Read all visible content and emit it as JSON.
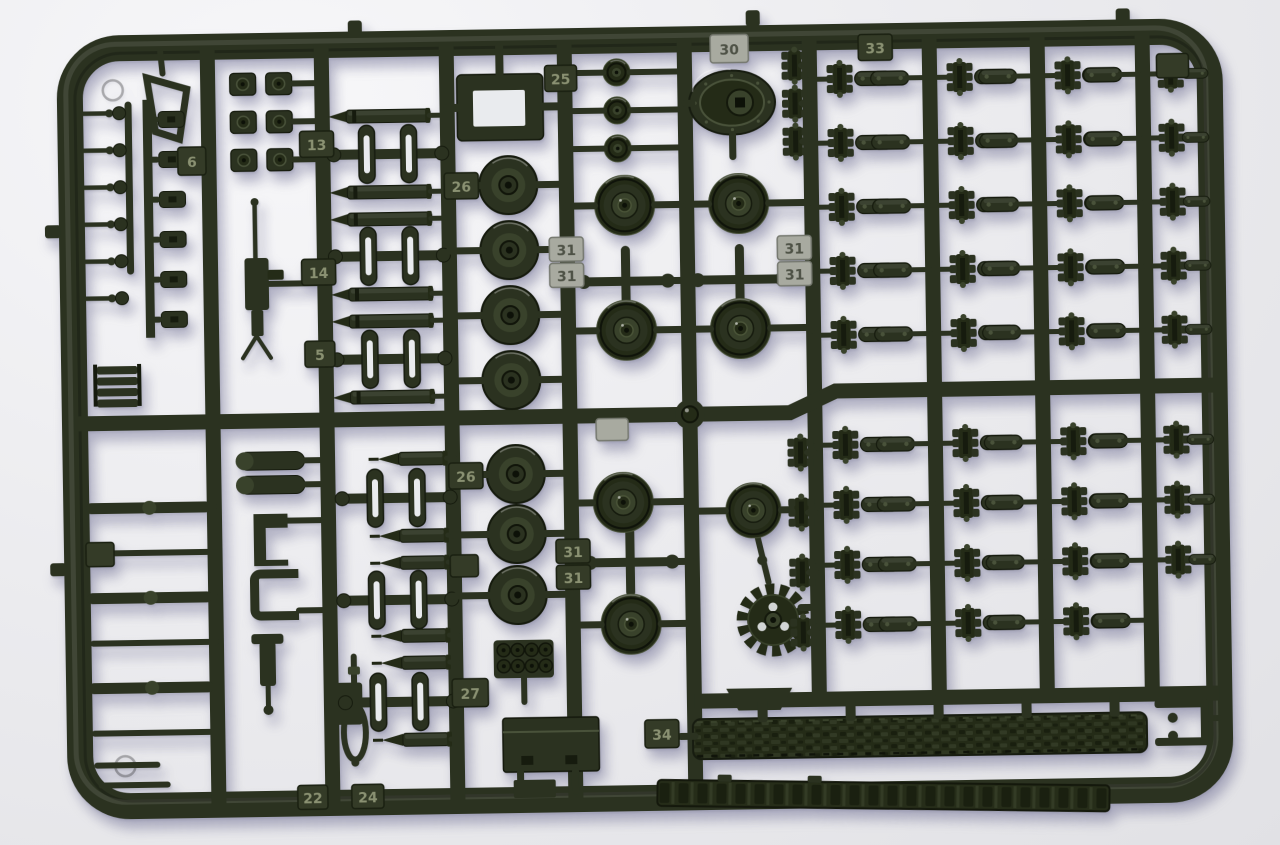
{
  "photo": {
    "subject": "Injection-molded plastic model kit sprue (parts tree) for an armored vehicle kit",
    "material": "dark olive-green styrene plastic",
    "backdrop": "light grey photographic background with soft shadow"
  },
  "colors": {
    "plastic": "#2b3220",
    "plastic-mid": "#242b17",
    "plastic-dark": "#161b0e",
    "plastic-deep": "#0d1108",
    "plastic-light": "#39422b",
    "plastic-light2": "#49523a",
    "hole-white": "#e9ebee",
    "tab-silver": "#a8aaa0",
    "tab-dark": "#343b27",
    "background": "#ededf0"
  },
  "part_number_tabs": [
    {
      "text": "30",
      "finish": "silver"
    },
    {
      "text": "25",
      "finish": "dark"
    },
    {
      "text": "33",
      "finish": "dark"
    },
    {
      "text": "6",
      "finish": "dark"
    },
    {
      "text": "13",
      "finish": "dark"
    },
    {
      "text": "14",
      "finish": "dark"
    },
    {
      "text": "5",
      "finish": "dark"
    },
    {
      "text": "26",
      "finish": "dark"
    },
    {
      "text": "31",
      "finish": "silver"
    },
    {
      "text": "31",
      "finish": "silver"
    },
    {
      "text": "31",
      "finish": "silver"
    },
    {
      "text": "31",
      "finish": "silver"
    },
    {
      "text": "26",
      "finish": "dark"
    },
    {
      "text": "31",
      "finish": "dark"
    },
    {
      "text": "31",
      "finish": "dark"
    },
    {
      "text": "27",
      "finish": "dark"
    },
    {
      "text": "34",
      "finish": "dark"
    },
    {
      "text": "22",
      "finish": "dark"
    },
    {
      "text": "24",
      "finish": "dark"
    }
  ],
  "part_types": [
    "road-wheel",
    "rubber-rimmed-wheel",
    "return-roller",
    "drive-sprocket",
    "final-drive-housing",
    "track-link-cluster",
    "track-pad-link",
    "assembled-track-run",
    "flat-track-section",
    "ammo-round",
    "ap-ammo-round",
    "machine-gun",
    "vision-block",
    "stowage-box",
    "smoke-grenade-launchers",
    "tow-cable-eye",
    "suspension-rod",
    "grab-handle-pin",
    "part-number-tab"
  ]
}
